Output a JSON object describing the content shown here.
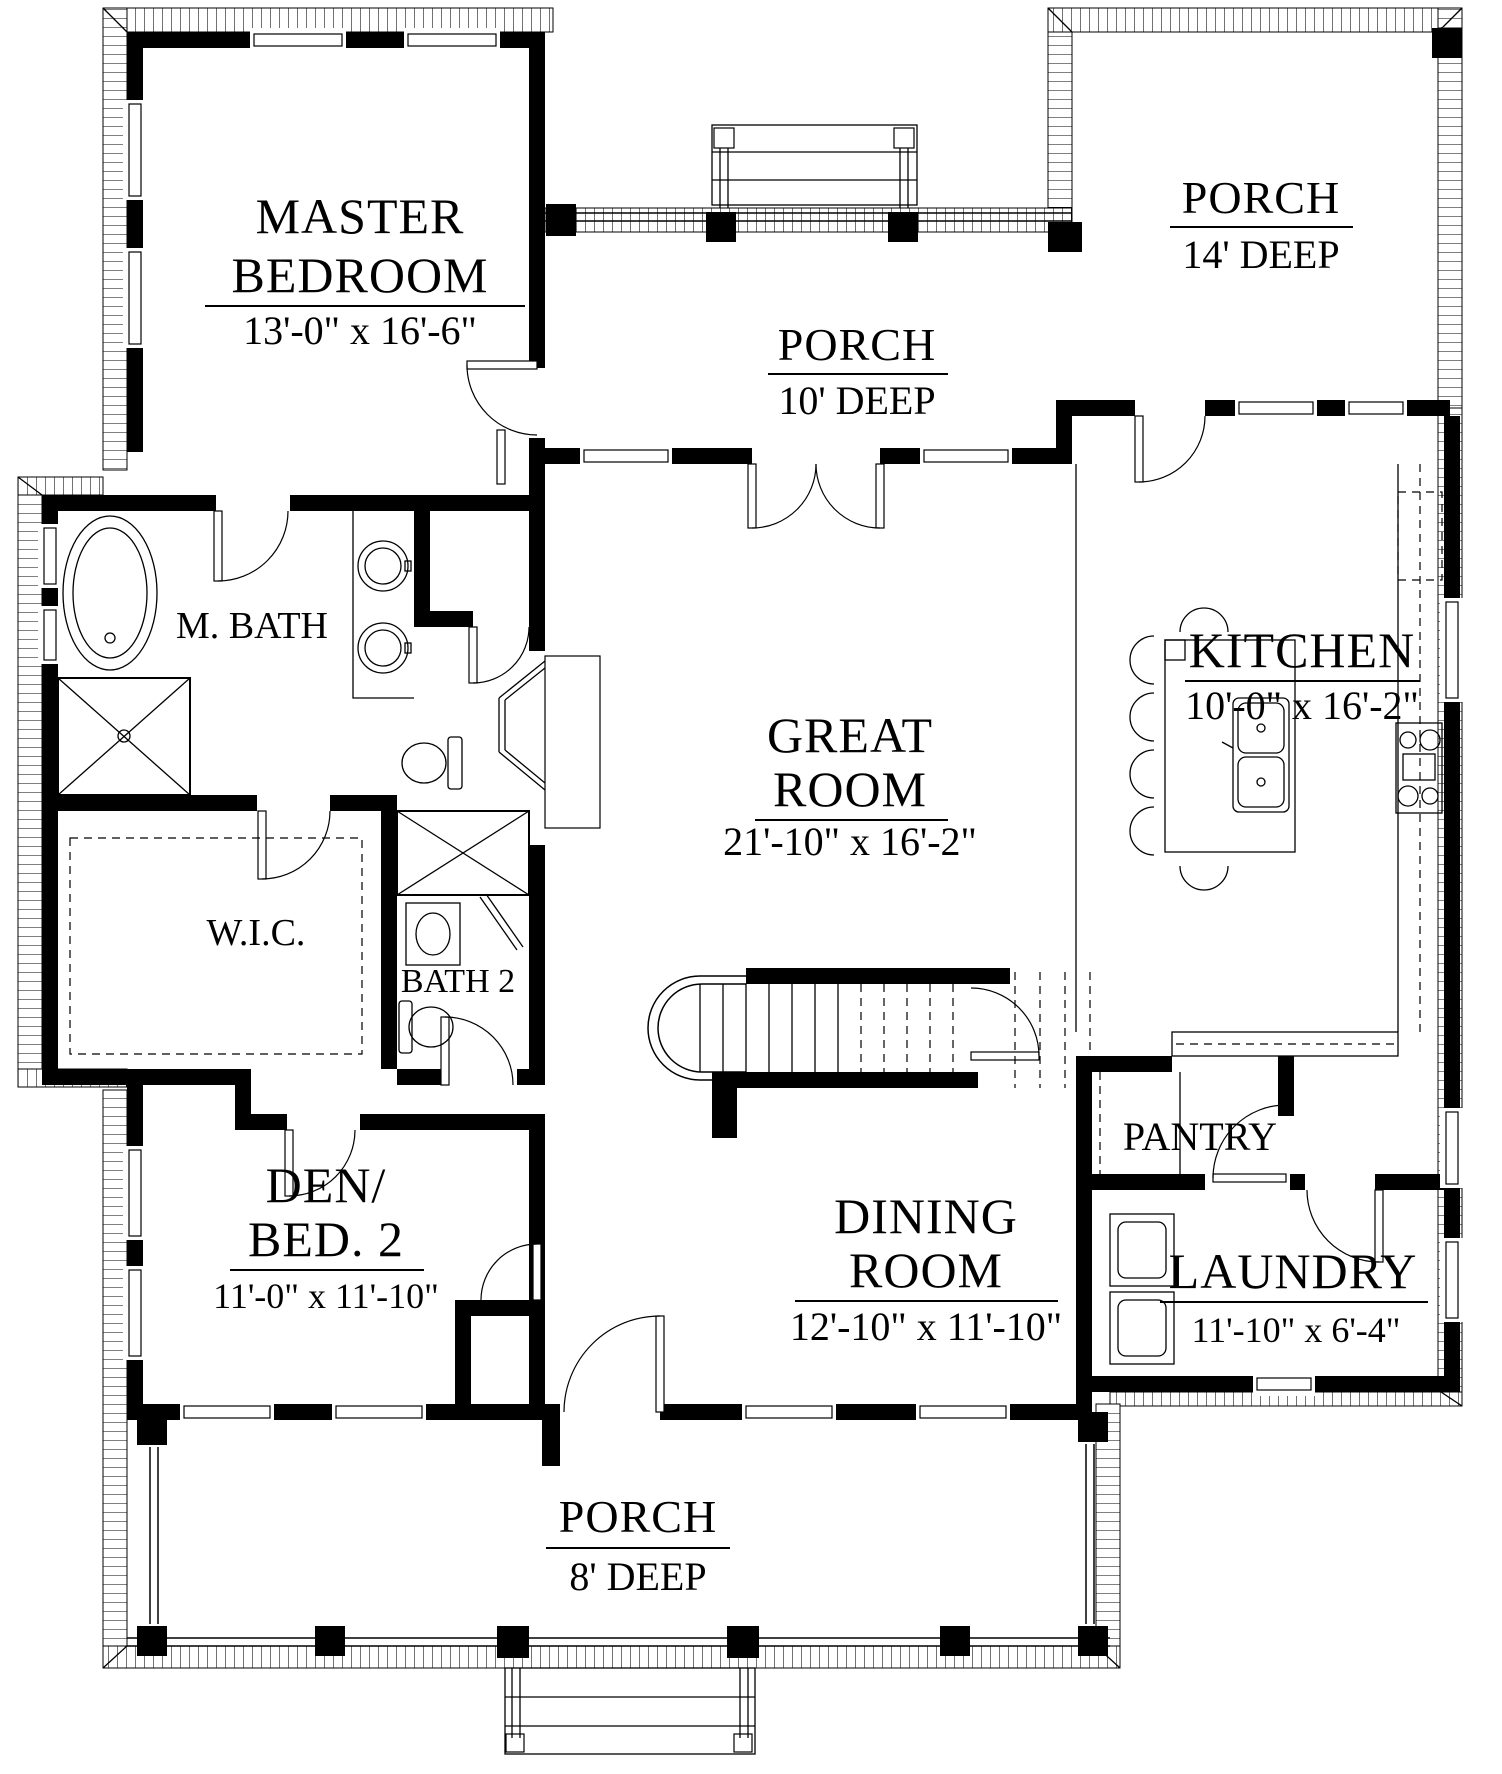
{
  "plan": {
    "colors": {
      "ink": "#000000",
      "paper": "#ffffff"
    },
    "rooms": {
      "master_bedroom": {
        "name_line1": "MASTER",
        "name_line2": "BEDROOM",
        "dims": "13'-0\" x 16'-6\""
      },
      "porch_rear": {
        "name": "PORCH",
        "depth": "10' DEEP"
      },
      "porch_side": {
        "name": "PORCH",
        "depth": "14' DEEP"
      },
      "porch_front": {
        "name": "PORCH",
        "depth": "8' DEEP"
      },
      "master_bath": {
        "name": "M. BATH"
      },
      "great_room": {
        "name_line1": "GREAT",
        "name_line2": "ROOM",
        "dims": "21'-10\" x 16'-2\""
      },
      "kitchen": {
        "name": "KITCHEN",
        "dims": "10'-0\" x 16'-2\""
      },
      "walk_in_closet": {
        "name": "W.I.C."
      },
      "bath2": {
        "name": "BATH 2"
      },
      "den": {
        "name_line1": "DEN/",
        "name_line2": "BED. 2",
        "dims": "11'-0\" x 11'-10\""
      },
      "dining": {
        "name_line1": "DINING",
        "name_line2": "ROOM",
        "dims": "12'-10\" x 11'-10\""
      },
      "pantry": {
        "name": "PANTRY"
      },
      "laundry": {
        "name": "LAUNDRY",
        "dims": "11'-10\" x 6'-4\""
      }
    }
  }
}
